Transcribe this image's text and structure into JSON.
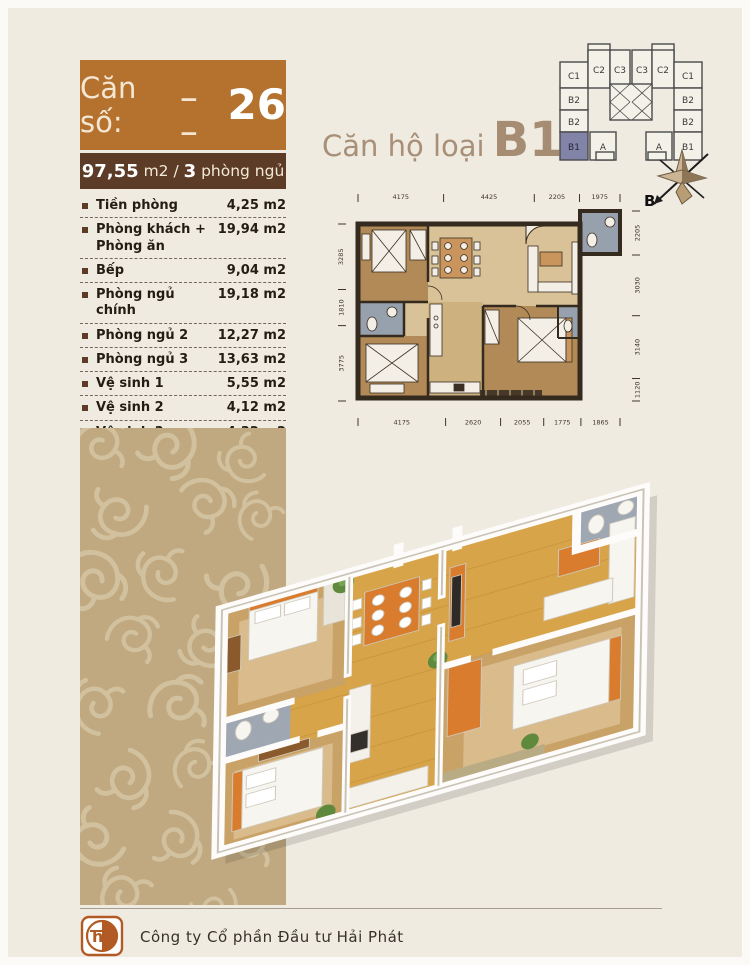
{
  "unit_box": {
    "label": "Căn số:",
    "blank": "_ _",
    "number": "26"
  },
  "area_box": {
    "area": "97,55",
    "mid": " m2 / ",
    "bedrooms": "3",
    "bedrooms_label": " phòng ngủ"
  },
  "apartment_type": {
    "prefix": "Căn hộ loại",
    "code": "B1"
  },
  "rooms": [
    {
      "label": "Tiền phòng",
      "area": "4,25 m2"
    },
    {
      "label": "Phòng khách + Phòng ăn",
      "area": "19,94 m2"
    },
    {
      "label": "Bếp",
      "area": "9,04 m2"
    },
    {
      "label": "Phòng ngủ chính",
      "area": "19,18 m2"
    },
    {
      "label": "Phòng ngủ 2",
      "area": "12,27 m2"
    },
    {
      "label": "Phòng ngủ 3",
      "area": "13,63 m2"
    },
    {
      "label": "Vệ sinh 1",
      "area": "5,55 m2"
    },
    {
      "label": "Vệ sinh 2",
      "area": "4,12 m2"
    },
    {
      "label": "Vệ sinh 3",
      "area": "4,32 m2"
    },
    {
      "label": "Lô gia",
      "area": "5,25 m2"
    }
  ],
  "locator": {
    "units": [
      "C1",
      "C2",
      "C3",
      "C3",
      "C2",
      "C1",
      "B2",
      "B2",
      "B2",
      "B2",
      "B1",
      "A",
      "A",
      "B1"
    ],
    "highlighted": "B1"
  },
  "compass": {
    "label": "B"
  },
  "plan2d": {
    "dims_top": [
      "4175",
      "4425",
      "2205",
      "1975"
    ],
    "dims_bottom": [
      "4175",
      "2620",
      "2055",
      "1775",
      "1865"
    ],
    "dims_left": [
      "3285",
      "1810",
      "3775"
    ],
    "dims_right": [
      "2205",
      "3030",
      "3140",
      "1120"
    ]
  },
  "footer": {
    "company": "Công ty Cổ phần Đầu tư Hải Phát",
    "logo_text": "hp"
  },
  "colors": {
    "accent_orange": "#b5722e",
    "dark_brown": "#5c3b27",
    "pattern_tan": "#c0a981",
    "title_taupe": "#a68c72",
    "locator_highlight": "#8284a7",
    "furniture_orange": "#d97c2e"
  }
}
